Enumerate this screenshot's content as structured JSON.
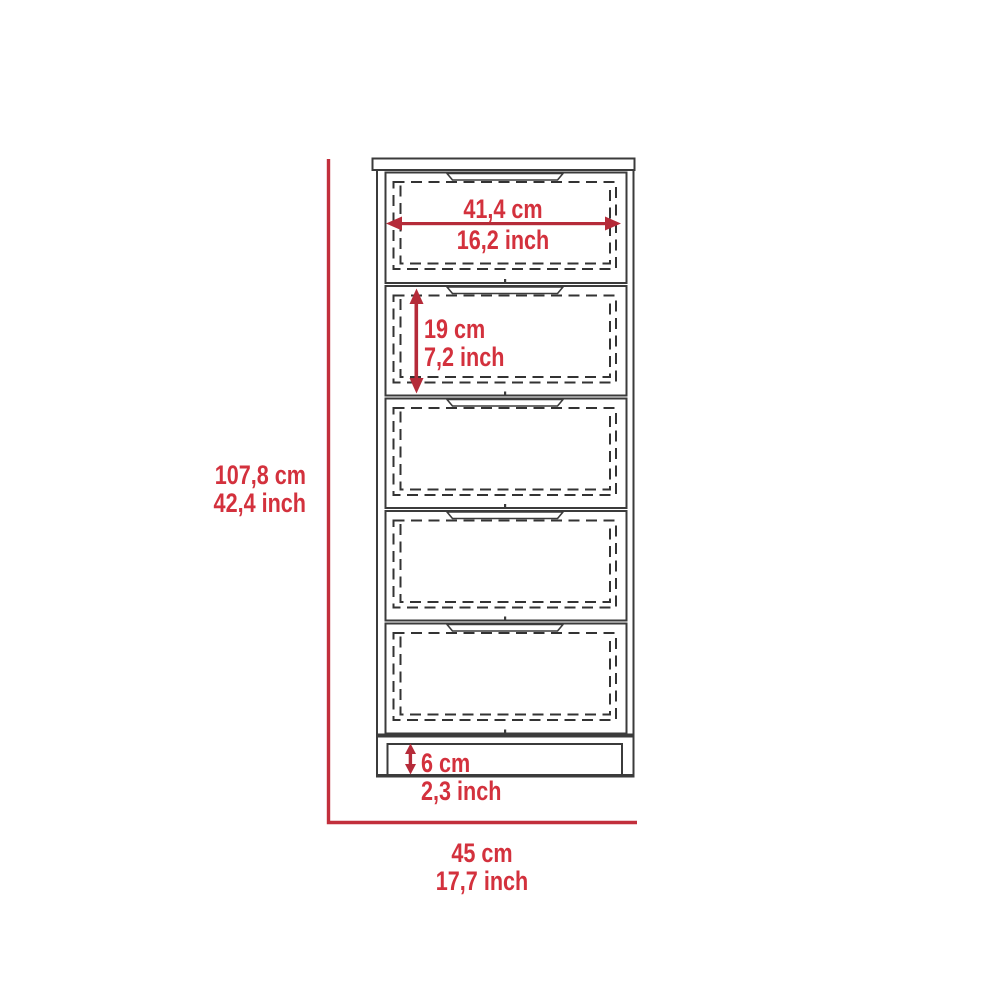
{
  "diagram": {
    "subject": "dresser with drawers",
    "drawer_count": 5,
    "colors": {
      "dimension_line_red": "#c22f3c",
      "dimension_text_red": "#d3313d",
      "outline_gray": "#3b3b3b"
    },
    "dimensions": {
      "drawer_width": {
        "metric": "41,4 cm",
        "imperial": "16,2 inch"
      },
      "drawer_height": {
        "metric": "19 cm",
        "imperial": "7,2 inch"
      },
      "total_height": {
        "metric": "107,8 cm",
        "imperial": "42,4 inch"
      },
      "base_height": {
        "metric": "6 cm",
        "imperial": "2,3 inch"
      },
      "total_width": {
        "metric": "45 cm",
        "imperial": "17,7 inch"
      }
    }
  }
}
